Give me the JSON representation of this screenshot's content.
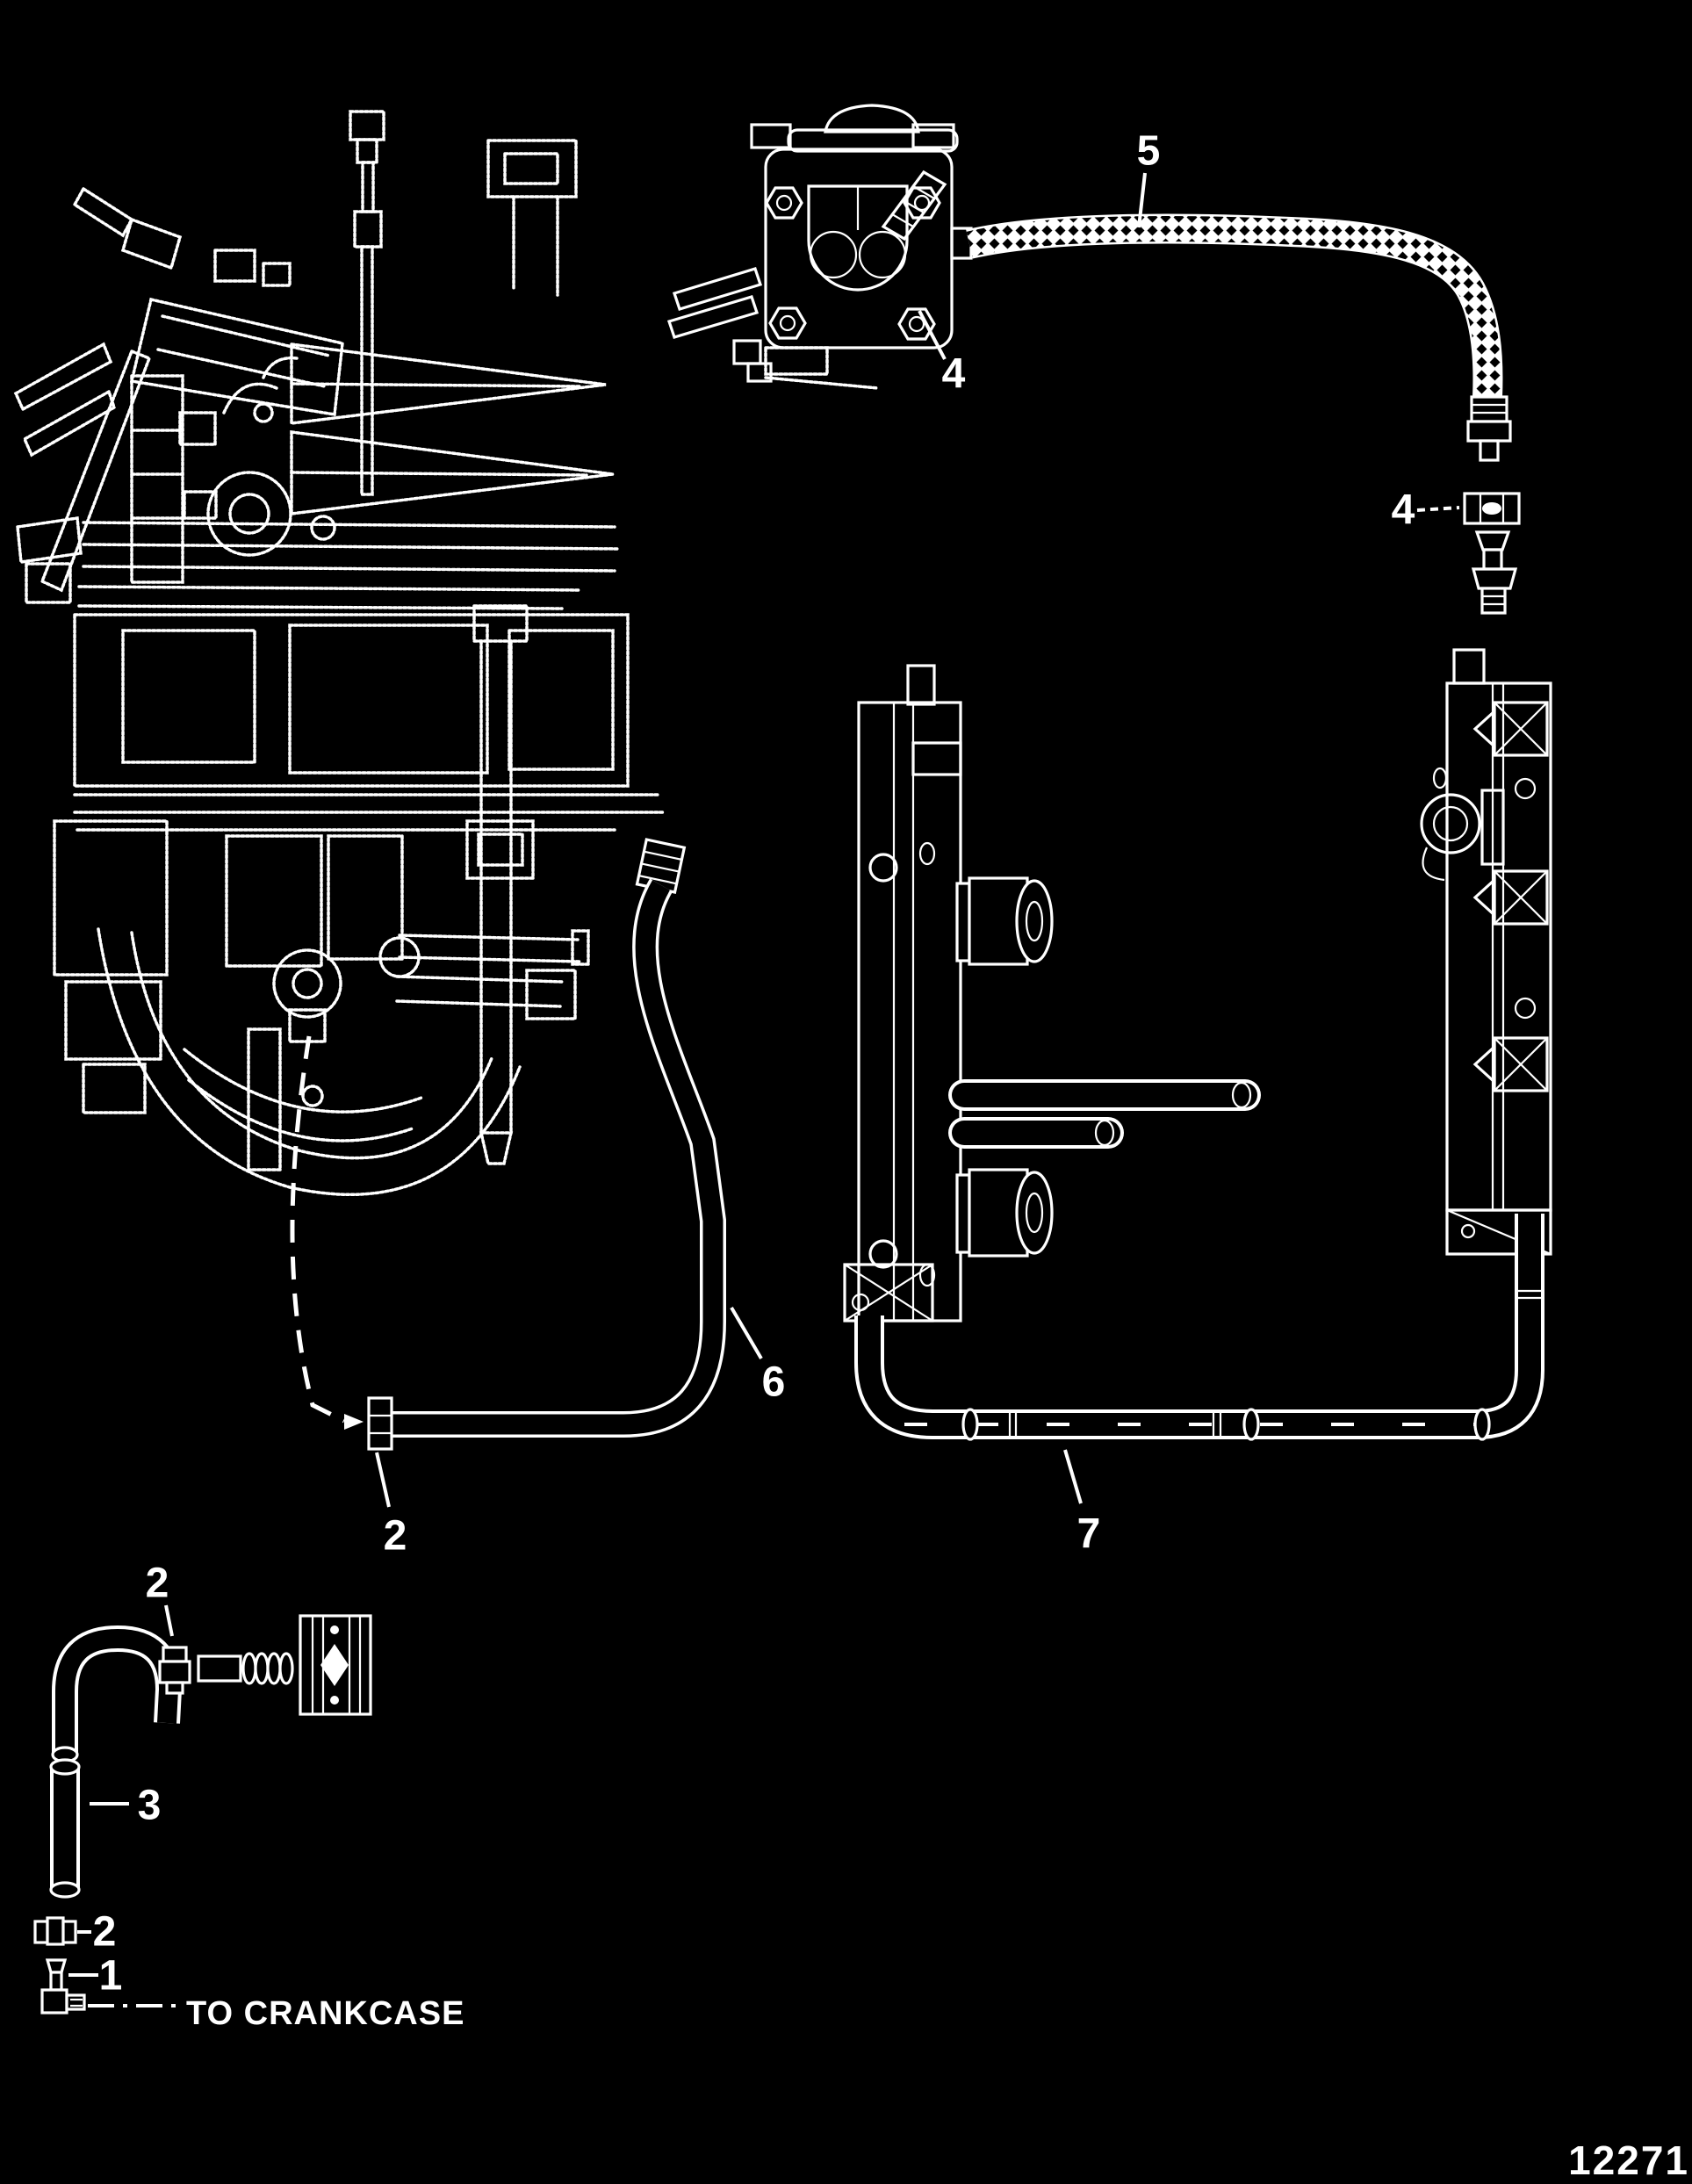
{
  "diagram": {
    "kind": "exploded-parts-diagram",
    "subject": "outboard powerhead fuel lines and fuel rails",
    "background_color": "#000000",
    "line_color": "#ffffff",
    "figure_number": "12271",
    "crankcase_note": "TO CRANKCASE"
  },
  "callouts": [
    {
      "label": "5",
      "target": "braided-fuel-hose"
    },
    {
      "label": "4",
      "target": "fuel-pump-outlet-fitting"
    },
    {
      "label": "4",
      "target": "hose-clamp"
    },
    {
      "label": "6",
      "target": "engine-to-rail-hose"
    },
    {
      "label": "2",
      "target": "hose-6-end-fitting"
    },
    {
      "label": "7",
      "target": "rail-to-rail-hose"
    },
    {
      "label": "2",
      "target": "check-valve-upper"
    },
    {
      "label": "3",
      "target": "straight-hose"
    },
    {
      "label": "2",
      "target": "check-valve-lower"
    },
    {
      "label": "1",
      "target": "crankcase-elbow-fitting"
    }
  ]
}
